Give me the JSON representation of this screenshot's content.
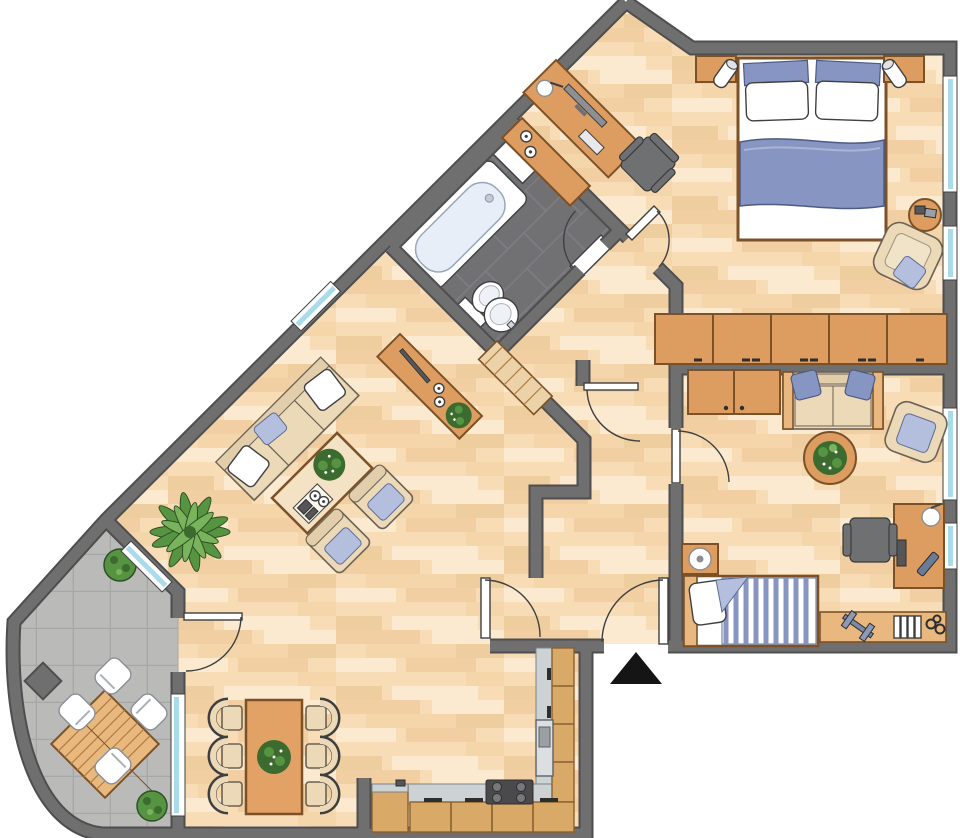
{
  "title": "apartment-floor-plan",
  "palette": {
    "wall": "#6f6f70",
    "wallDark": "#4e4e4f",
    "wood": "#f7dcb6",
    "woodA": "#f1cfa2",
    "woodB": "#fbe9d0",
    "woodC": "#eece9e",
    "woodD": "#f5d6ab",
    "bathTile": "#717174",
    "bathGrout": "#82828600",
    "grout": "#7f7f83",
    "terrace": "#babbb9",
    "terraceLine": "#a7a8a6",
    "orange": "#dd9c60",
    "orangeDark": "#7d5128",
    "orangeLight": "#e9b87e",
    "beige": "#ecd9b8",
    "beigeDark": "#6b6253",
    "blue": "#8795c2",
    "blueLight": "#b4bfdd",
    "white": "#ffffff",
    "line": "#3f3f3f",
    "green": "#579441",
    "greenDark": "#3c6b2f",
    "windowBlue": "#a9dbeb",
    "kitchenWood": "#d9a967",
    "counter": "#cdd2d5",
    "appliance": "#56565a",
    "entrance": "#151515"
  },
  "legend": {
    "entrance_marker": "black-triangle-arrow"
  },
  "rooms": [
    {
      "id": "master-bedroom",
      "furniture": [
        "double-bed",
        "nightstand-lamp-left",
        "nightstand-lamp-right",
        "desk-computer",
        "office-chair",
        "sideboard-candles",
        "armchair",
        "side-table-books",
        "closet-row-5-units",
        "windows-right-wall"
      ]
    },
    {
      "id": "bathroom",
      "furniture": [
        "bathtub",
        "shower-tray",
        "toilet",
        "washbasin",
        "door-swing"
      ]
    },
    {
      "id": "hallway",
      "furniture": [
        "wooden-bench",
        "sideboard-plant",
        "entrance-door",
        "vestibule-door"
      ]
    },
    {
      "id": "second-bedroom",
      "furniture": [
        "two-seat-sofa",
        "round-plant-table",
        "armchair",
        "desk-lamp-chair",
        "single-bed-striped",
        "nightstand-lamp",
        "low-shelf-dumbbell-books",
        "wardrobe-2-doors",
        "windows-right-wall"
      ]
    },
    {
      "id": "living-room",
      "furniture": [
        "three-seat-sofa",
        "coffee-table-plant-tray",
        "armchair-1",
        "armchair-2",
        "palm-plant",
        "dining-table-plant",
        "six-dining-chairs",
        "terrace-door",
        "diagonal-window"
      ]
    },
    {
      "id": "kitchen",
      "furniture": [
        "l-shaped-counter",
        "cooktop-4-burners",
        "oven",
        "cabinet-row",
        "side-cabinet"
      ]
    },
    {
      "id": "terrace",
      "furniture": [
        "slatted-garden-table",
        "four-garden-chairs",
        "potted-plant-top",
        "potted-plant-bottom",
        "curved-outer-wall",
        "window-to-dining"
      ]
    }
  ]
}
